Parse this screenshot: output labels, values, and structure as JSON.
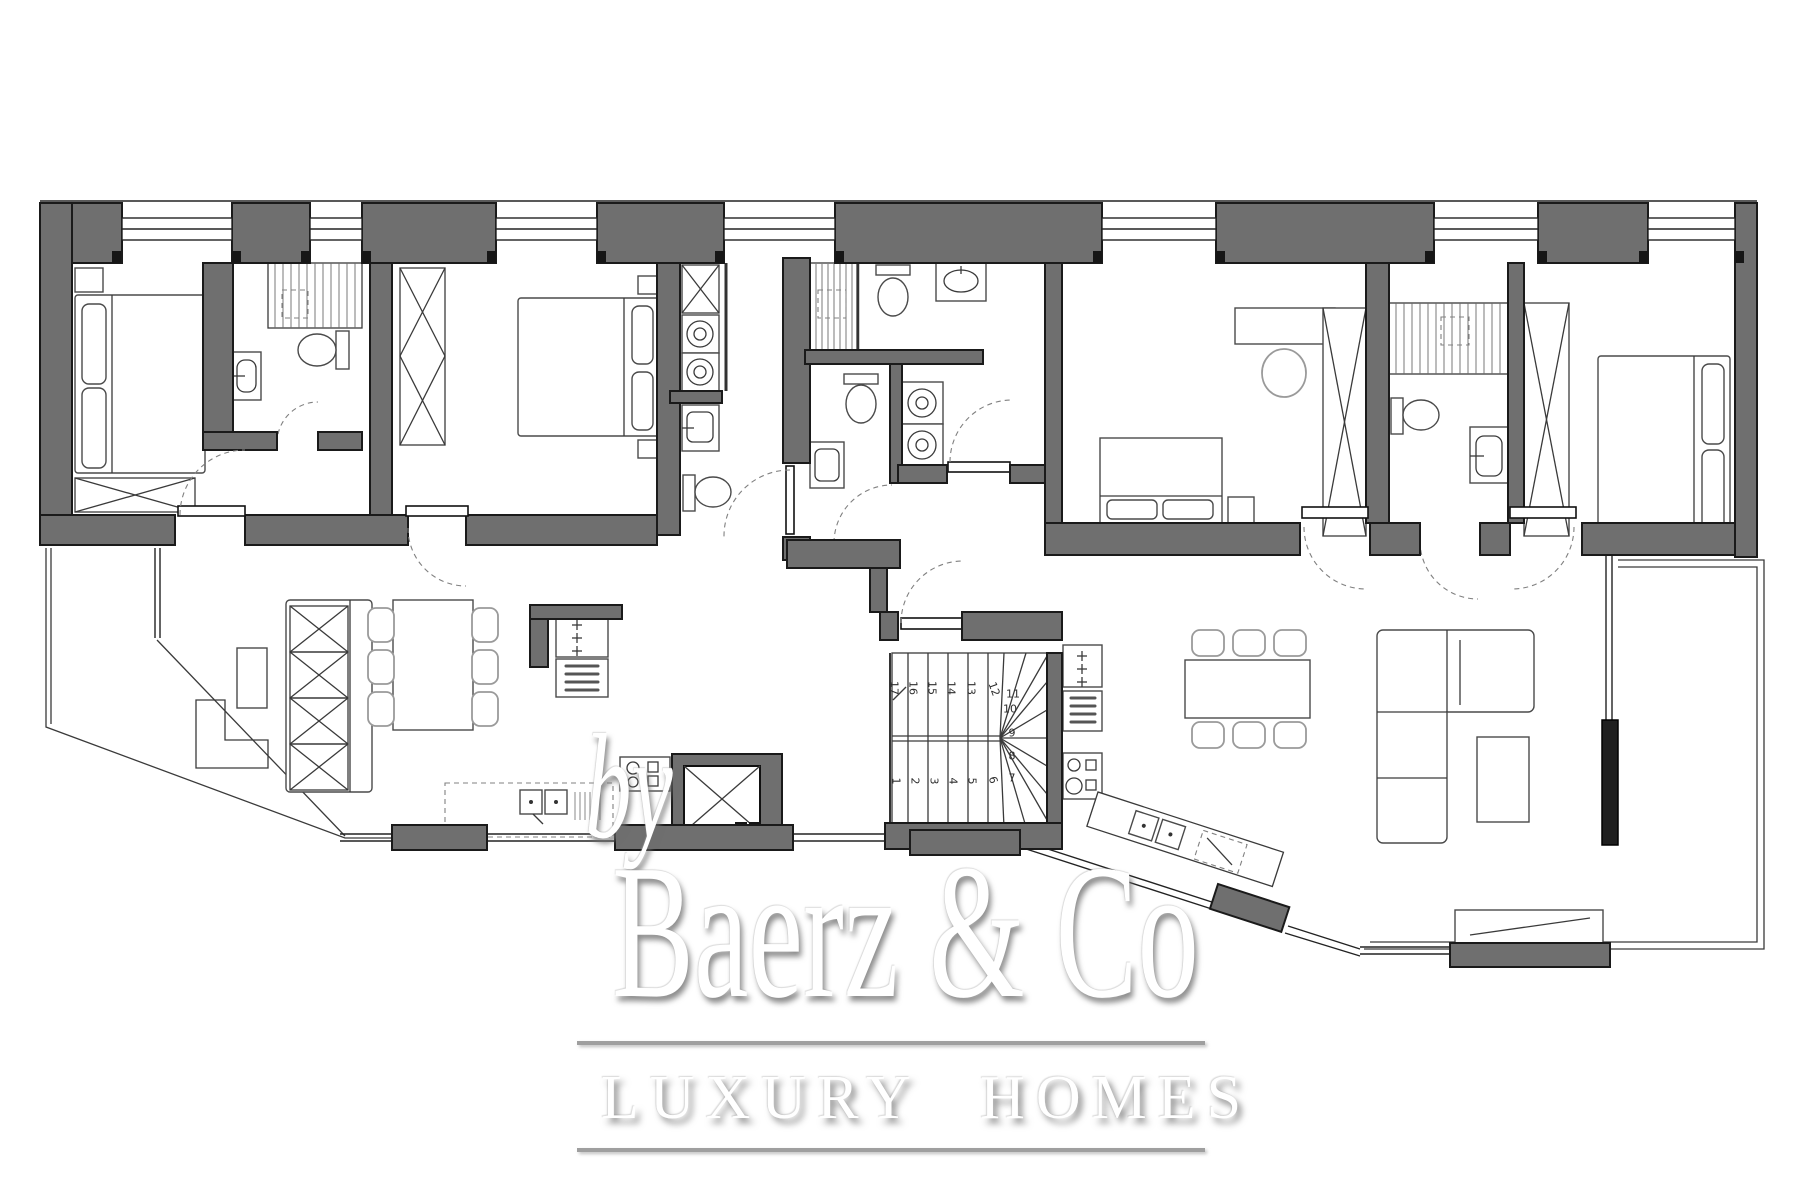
{
  "watermark": {
    "by": "by",
    "brand": "Baerz & Co",
    "tagline": "LUXURY HOMES"
  },
  "stairs": {
    "steps": [
      "1",
      "2",
      "3",
      "4",
      "5",
      "6",
      "7",
      "8",
      "9",
      "10",
      "11",
      "12",
      "13",
      "14",
      "15",
      "16",
      "17"
    ]
  },
  "colors": {
    "background": "#ffffff",
    "wall": "#6f6f6f",
    "wall_outline": "#1a1a1a",
    "black_wall": "#1f1f1f",
    "line": "#3a3a3a",
    "furniture": "#4a4a4a",
    "light": "#9a9a9a",
    "glazing": "#222222",
    "dash": "#808080",
    "step_number": "#2e2e2e",
    "watermark": "#ffffff",
    "watermark_shadow": "#8c8c8c",
    "rule": "#9f9f9f"
  }
}
